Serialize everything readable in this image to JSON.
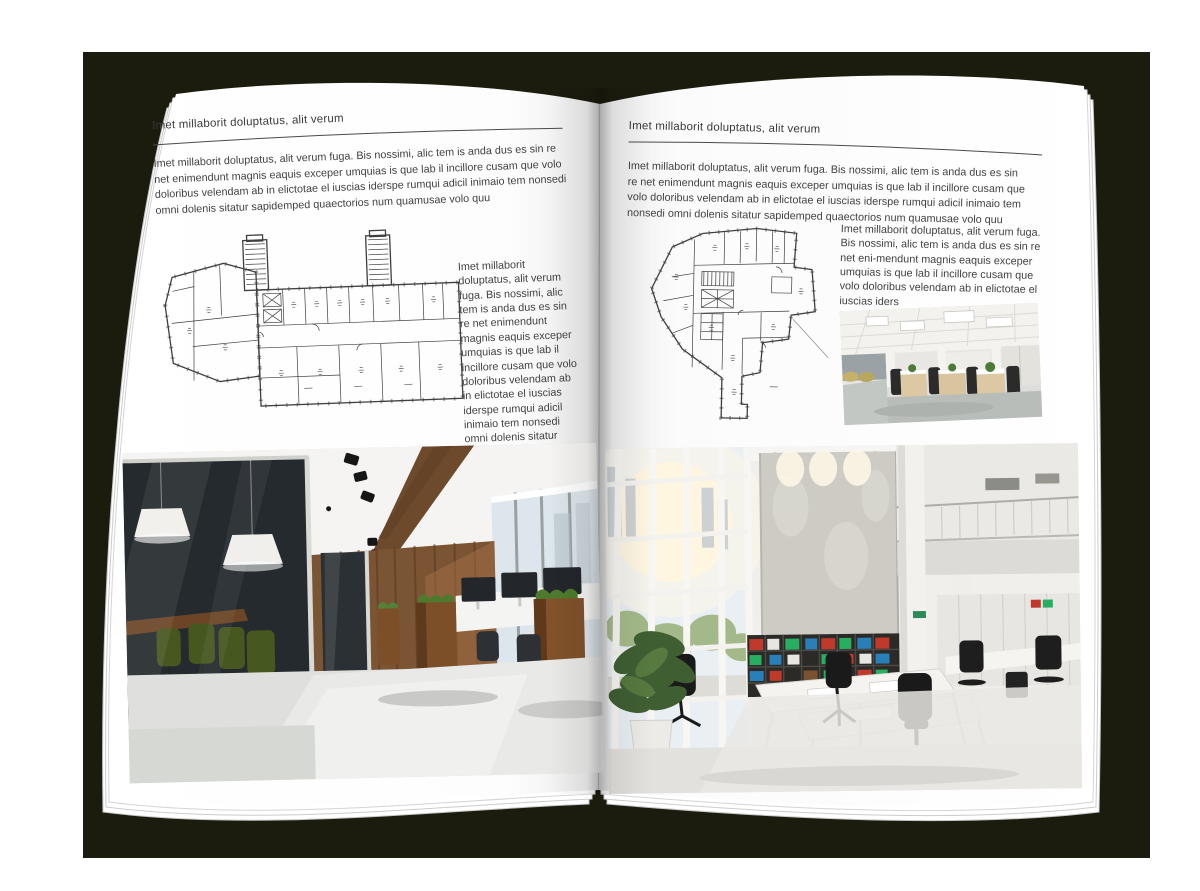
{
  "scene": {
    "type": "open-magazine-spread-mockup",
    "backdrop_color": "#1b1b0e",
    "page_color": "#ffffff",
    "text_color": "#3d3d3d"
  },
  "left_page": {
    "header": "Imet millaborit doluptatus, alit verum",
    "intro": "Imet millaborit doluptatus, alit verum fuga. Bis nossimi, alic tem is anda dus es sin re net enimendunt magnis eaquis exceper umquias is que lab il incillore cusam que volo doloribus velendam ab in elictotae el iuscias iderspe rumqui adicil inimaio tem nonsedi omni dolenis sitatur sapidemped quaectorios num quamusae volo quu",
    "sidebar_text": "Imet millaborit doluptatus, alit verum fuga. Bis nossimi, alic tem is anda dus es sin re net enimendunt magnis eaquis exceper umquias is que lab il incillore cusam que volo doloribus velendam ab in elictotae el iuscias iderspe rumqui adicil inimaio tem nonsedi omni dolenis sitatur sapidemped quaectorios num quamusae volo quu",
    "images": {
      "floor_plan": "architectural-floor-plan-wide-building",
      "photo_large": "dark-glass-meeting-room-open-office"
    }
  },
  "right_page": {
    "header": "Imet millaborit doluptatus, alit verum",
    "intro": "Imet millaborit doluptatus, alit verum fuga. Bis nossimi, alic tem is anda dus es sin re net enimendunt magnis eaquis exceper umquias is que lab il incillore cusam que volo doloribus velendam ab in elictotae el iuscias iderspe rumqui adicil inimaio tem nonsedi omni dolenis sitatur sapidemped quaectorios num quamusae volo quu",
    "sidebar_text": "Imet millaborit doluptatus, alit verum fuga. Bis nossimi, alic tem is anda dus es sin re net eni-mendunt magnis eaquis exceper umquias is que lab il incillore cusam que volo doloribus velendam ab in elictotae el iuscias iders",
    "images": {
      "floor_plan": "architectural-floor-plan-irregular-building",
      "photo_small": "white-open-plan-office-workstations",
      "photo_large": "bright-atrium-office-bookshelf-wall"
    }
  }
}
